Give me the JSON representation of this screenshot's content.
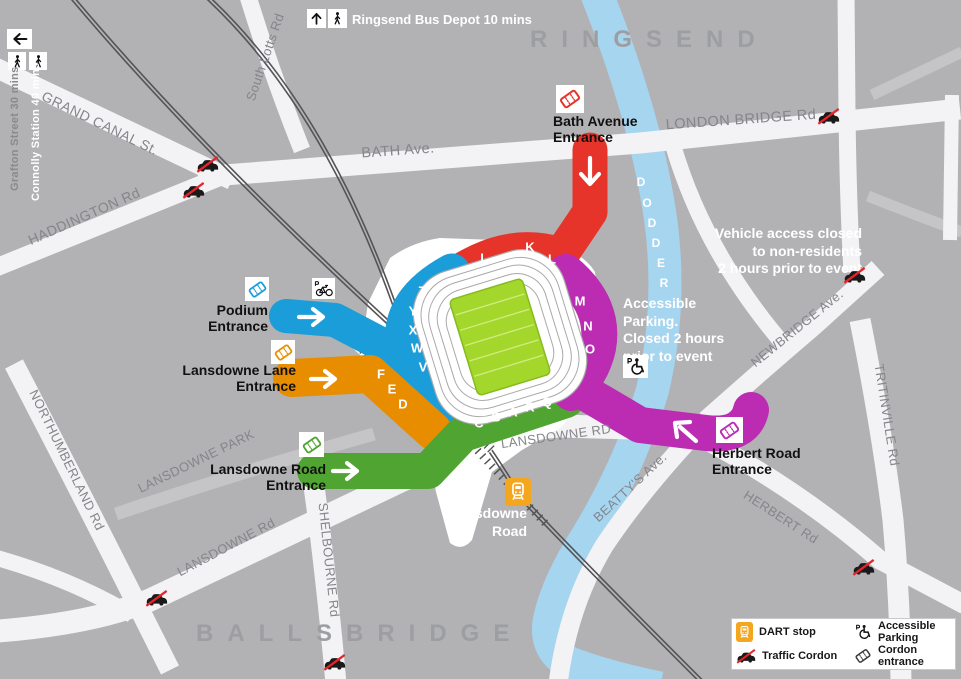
{
  "map": {
    "north_area": "RINGSEND",
    "south_area": "BALLSBRIDGE"
  },
  "streets": {
    "grand_canal": "GRAND CANAL St.",
    "south_lotts": "South Lotts Rd",
    "bath_ave": "BATH Ave.",
    "london_bridge": "LONDON BRIDGE Rd",
    "haddington": "HADDINGTON Rd",
    "northumberland": "NORTHUMBERLAND Rd",
    "lansdowne_park": "LANSDOWNE PARK",
    "lansdowne_rd_sw": "LANSDOWNE Rd",
    "shelbourne": "SHELBOURNE Rd",
    "lansdowne_rd_main": "LANSDOWNE RD",
    "beattys": "BEATTY'S Ave.",
    "herbert": "HERBERT Rd",
    "newbridge": "NEWBRIDGE Ave.",
    "tritonville": "TRITINVILLE Rd",
    "dodder_letters": [
      "D",
      "O",
      "D",
      "D",
      "E",
      "R"
    ]
  },
  "entrances": {
    "bath": {
      "line1": "Bath Avenue",
      "line2": "Entrance"
    },
    "podium": {
      "line1": "Podium",
      "line2": "Entrance"
    },
    "lansdowne_lane": {
      "line1": "Lansdowne Lane",
      "line2": "Entrance"
    },
    "lansdowne_road": {
      "line1": "Lansdowne Road",
      "line2": "Entrance"
    },
    "herbert_road": {
      "line1": "Herbert Road",
      "line2": "Entrance"
    }
  },
  "stand_sections": {
    "north_red": [
      "I",
      "K",
      "L"
    ],
    "west_blue": [
      "Z",
      "Y",
      "X",
      "W",
      "V"
    ],
    "southwest_orange": [
      "F",
      "E",
      "D"
    ],
    "south_green": [
      "C",
      "B",
      "A",
      "R",
      "Q"
    ],
    "east_magenta": [
      "M",
      "N",
      "O"
    ]
  },
  "notes": {
    "bus_depot": "Ringsend Bus Depot 10 mins",
    "grafton": "Grafton Street 30 mins",
    "connolly": "Connolly Station 40 mins",
    "vehicle_access_lines": [
      "Vehicle access closed",
      "to non-residents",
      "2 hours prior to event"
    ],
    "accessible_parking_lines": [
      "Accessible",
      "Parking.",
      "Closed 2 hours",
      "prior to event"
    ]
  },
  "station": {
    "line1": "Lansdowne",
    "line2": "Road"
  },
  "legend": {
    "dart": "DART stop",
    "traffic": "Traffic Cordon",
    "accessible": "Accessible Parking",
    "cordon": "Cordon entrance"
  },
  "colors": {
    "route_red": "#e6342b",
    "route_blue": "#1b9dd9",
    "route_orange": "#e88d00",
    "route_green": "#50a431",
    "route_magenta": "#bc2cb2",
    "river": "#a6d5f0",
    "pitch": "#a4d72b",
    "dart_orange": "#f5a61f"
  }
}
